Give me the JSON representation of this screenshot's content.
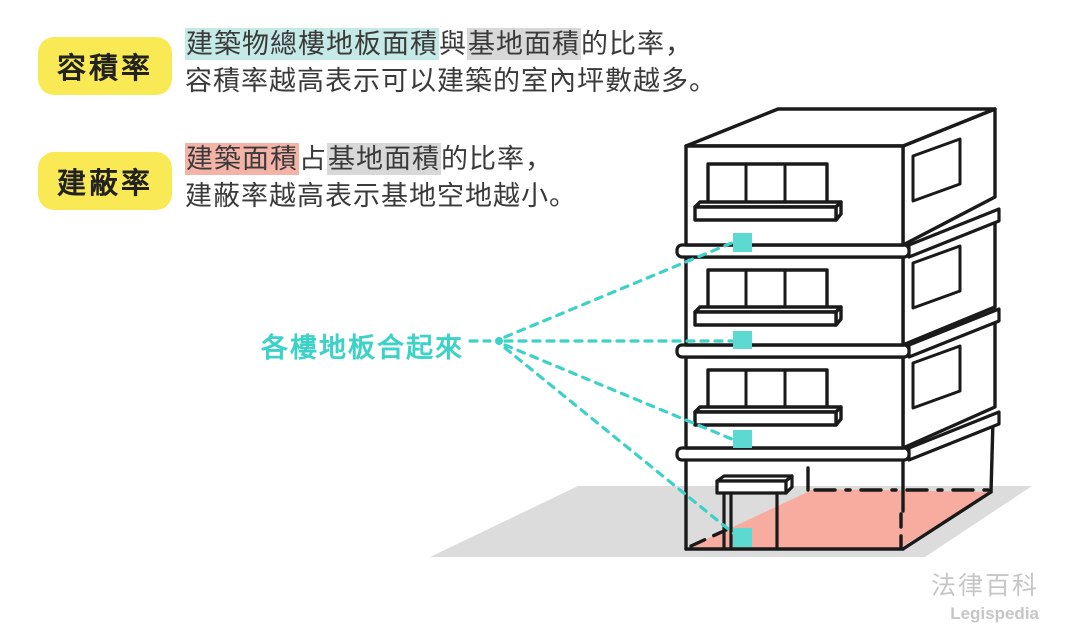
{
  "colors": {
    "yellow": "#F9E954",
    "tealhl": "#C4E9E6",
    "grayhl": "#D8D8D8",
    "pinkhl": "#F5B3A8",
    "accent": "#3DD2C8",
    "accentlight": "#5CDAD1",
    "pinkfloor": "#F8AC9F",
    "groundgray": "#DCDCDC",
    "ink": "#1A1A1A",
    "text": "#3A3A3A",
    "wm": "#C6C6C6"
  },
  "definitions": [
    {
      "term": "容積率",
      "line1_seg1": "建築物總樓地板面積",
      "line1_seg2": "與",
      "line1_seg3": "基地面積",
      "line1_seg4": "的比率，",
      "line2": "容積率越高表示可以建築的室內坪數越多。"
    },
    {
      "term": "建蔽率",
      "line1_seg1": "建築面積",
      "line1_seg2": "占",
      "line1_seg3": "基地面積",
      "line1_seg4": "的比率，",
      "line2": "建蔽率越高表示基地空地越小。"
    }
  ],
  "diagram": {
    "floors_label": "各樓地板合起來",
    "floor_marker_count": 4,
    "building_floors": 4
  },
  "watermark": {
    "title": "法律百科",
    "subtitle": "Legispedia"
  }
}
